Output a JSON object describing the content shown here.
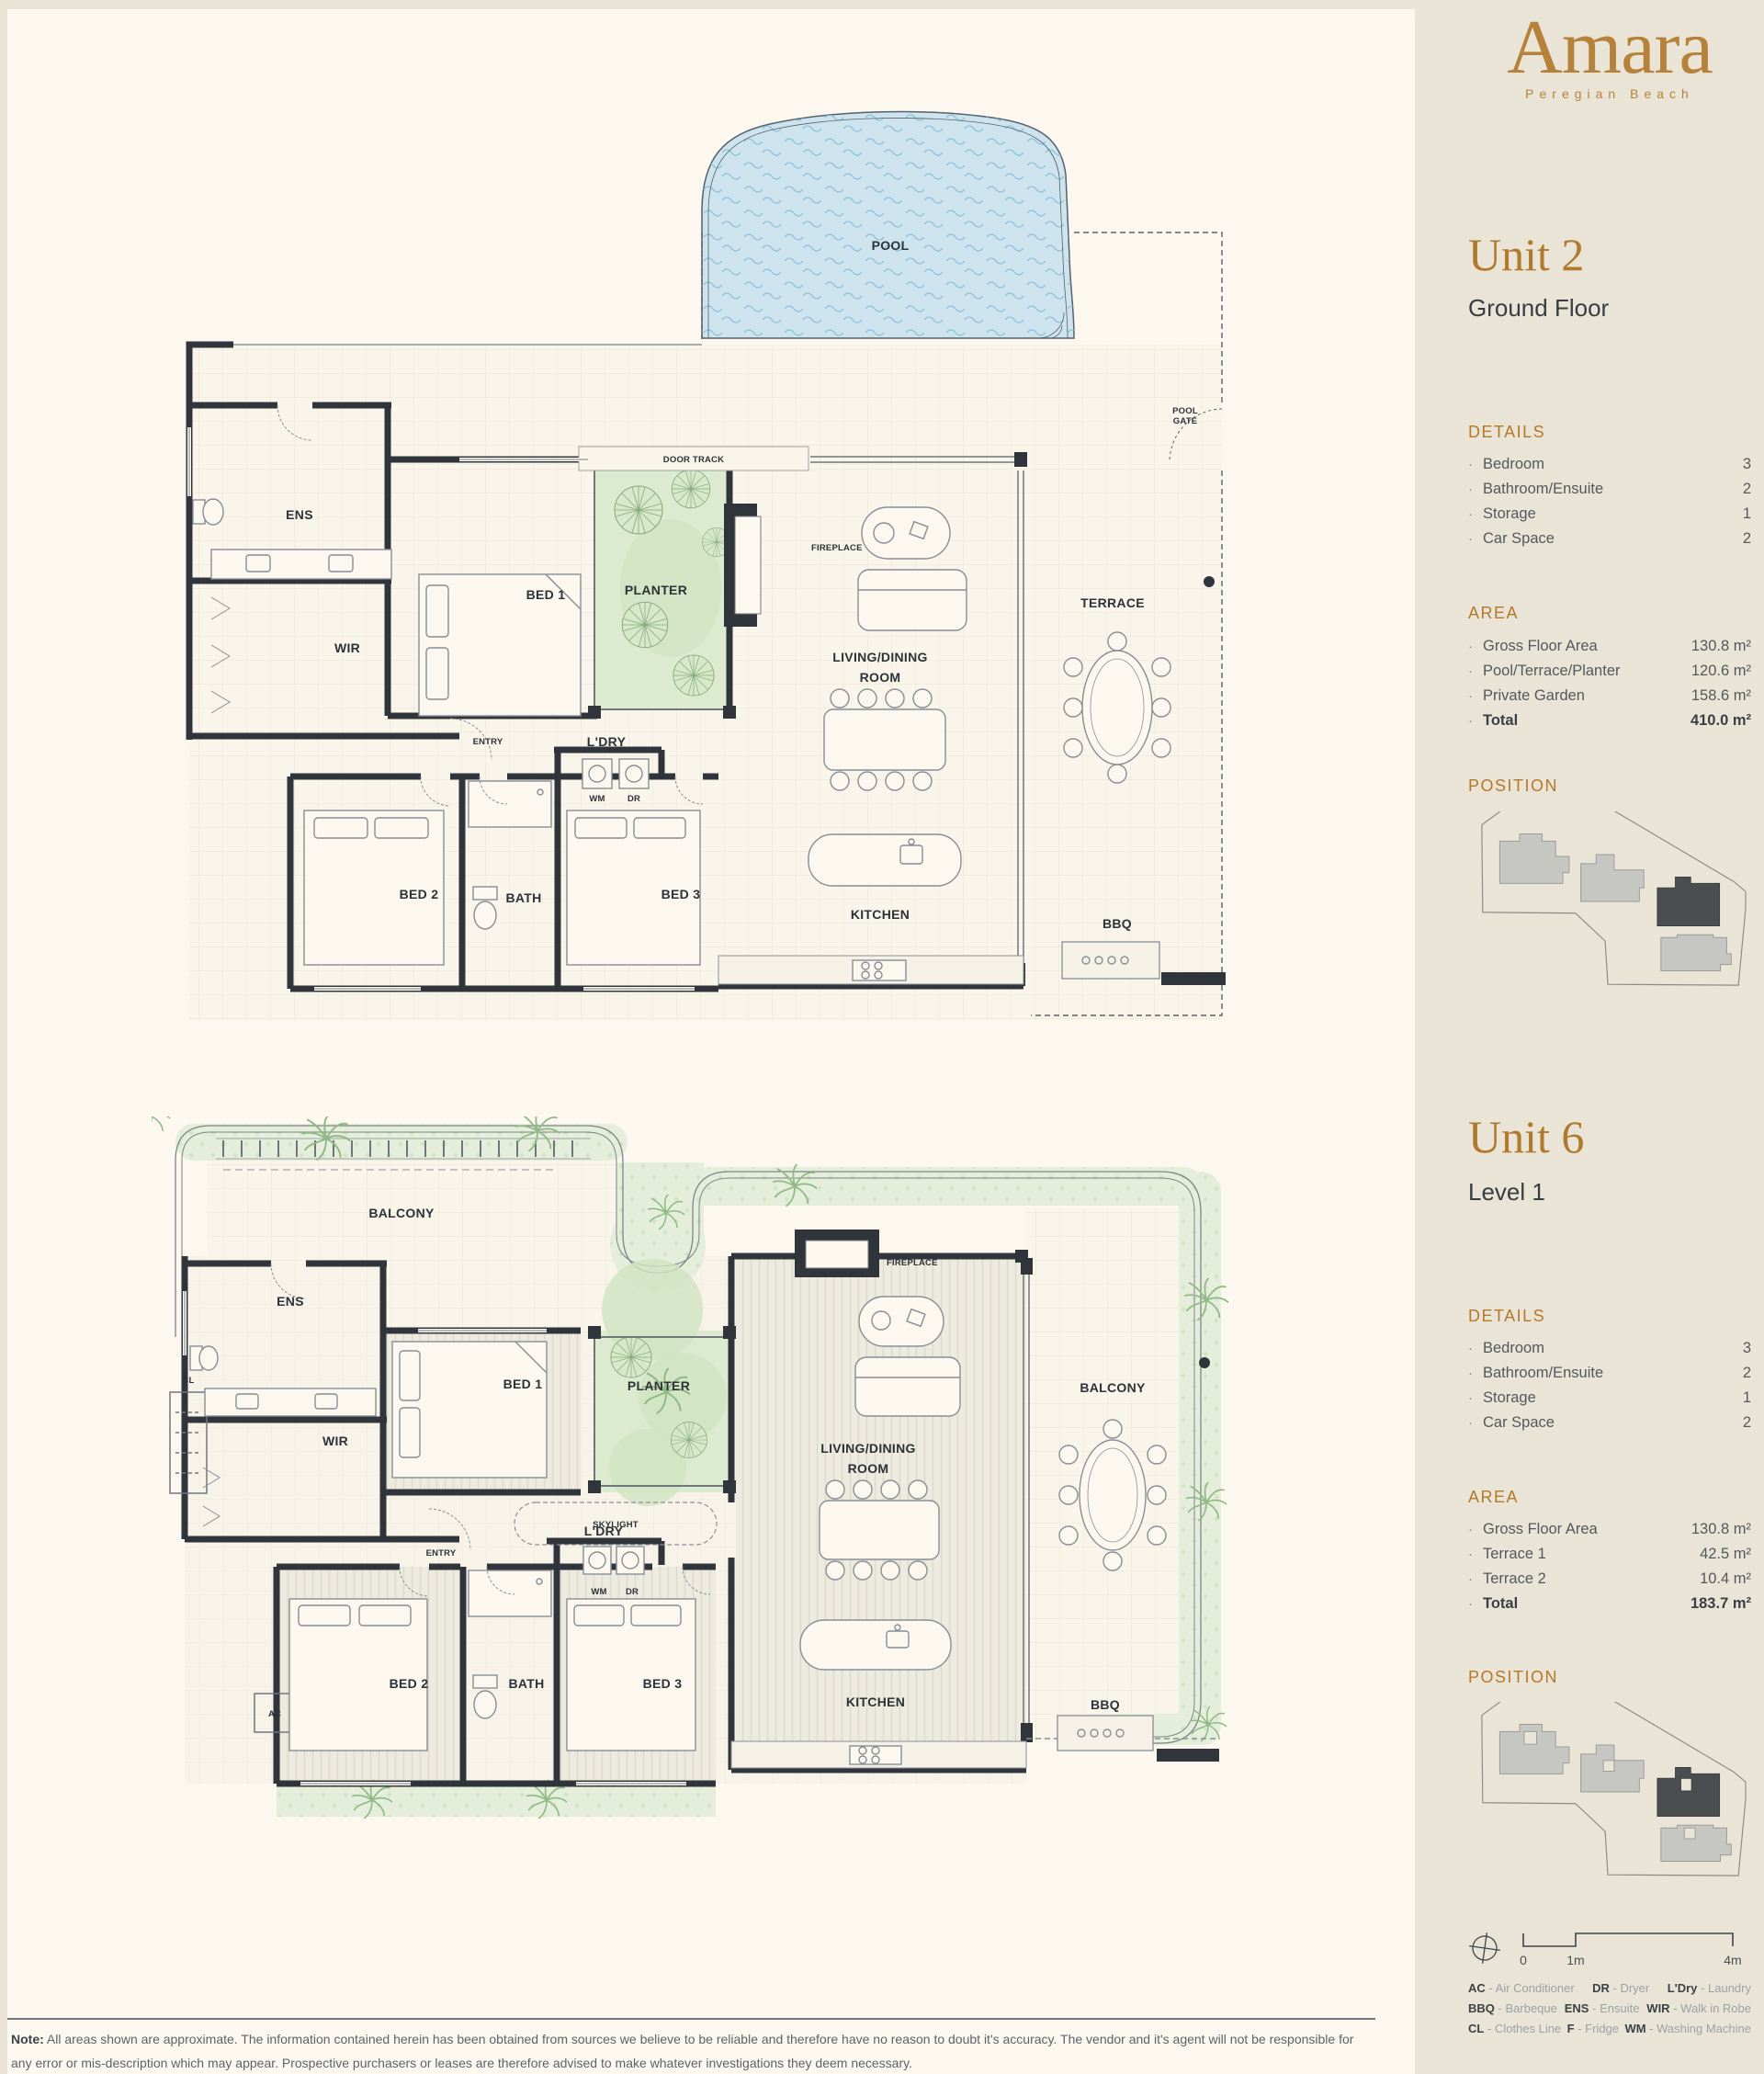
{
  "brand": {
    "name": "Amara",
    "tagline": "Peregian Beach"
  },
  "units": [
    {
      "name": "Unit 2",
      "floor": "Ground Floor",
      "details_title": "DETAILS",
      "details": [
        {
          "label": "Bedroom",
          "value": "3"
        },
        {
          "label": "Bathroom/Ensuite",
          "value": "2"
        },
        {
          "label": "Storage",
          "value": "1"
        },
        {
          "label": "Car Space",
          "value": "2"
        }
      ],
      "area_title": "AREA",
      "area": [
        {
          "label": "Gross Floor Area",
          "value": "130.8 m²"
        },
        {
          "label": "Pool/Terrace/Planter",
          "value": "120.6 m²"
        },
        {
          "label": "Private Garden",
          "value": "158.6 m²"
        },
        {
          "label": "Total",
          "value": "410.0 m²"
        }
      ],
      "position_title": "POSITION"
    },
    {
      "name": "Unit 6",
      "floor": "Level 1",
      "details_title": "DETAILS",
      "details": [
        {
          "label": "Bedroom",
          "value": "3"
        },
        {
          "label": "Bathroom/Ensuite",
          "value": "2"
        },
        {
          "label": "Storage",
          "value": "1"
        },
        {
          "label": "Car Space",
          "value": "2"
        }
      ],
      "area_title": "AREA",
      "area": [
        {
          "label": "Gross Floor Area",
          "value": "130.8 m²"
        },
        {
          "label": "Terrace 1",
          "value": "42.5 m²"
        },
        {
          "label": "Terrace 2",
          "value": "10.4 m²"
        },
        {
          "label": "Total",
          "value": "183.7 m²"
        }
      ],
      "position_title": "POSITION"
    }
  ],
  "plans": {
    "unit2": {
      "pool": "POOL",
      "door_track": "DOOR TRACK",
      "pool_gate1": "POOL",
      "pool_gate2": "GATE",
      "fireplace": "FIREPLACE",
      "ens": "ENS",
      "wir": "WIR",
      "bed1": "BED 1",
      "planter": "PLANTER",
      "living1": "LIVING/DINING",
      "living2": "ROOM",
      "terrace": "TERRACE",
      "entry": "ENTRY",
      "ldry": "L'DRY",
      "wm": "WM",
      "dr": "DR",
      "bed2": "BED 2",
      "bath": "BATH",
      "bed3": "BED 3",
      "kitchen": "KITCHEN",
      "bbq": "BBQ"
    },
    "unit6": {
      "balcony1": "BALCONY",
      "ens": "ENS",
      "cl": "CL",
      "wir": "WIR",
      "bed1": "BED 1",
      "planter": "PLANTER",
      "fireplace": "FIREPLACE",
      "living1": "LIVING/DINING",
      "living2": "ROOM",
      "balcony2": "BALCONY",
      "skylight": "SKYLIGHT",
      "entry": "ENTRY",
      "ldry": "L'DRY",
      "wm": "WM",
      "dr": "DR",
      "ac": "AC",
      "bed2": "BED 2",
      "bath": "BATH",
      "bed3": "BED 3",
      "kitchen": "KITCHEN",
      "bbq": "BBQ"
    }
  },
  "scale": {
    "zero": "0",
    "one": "1m",
    "four": "4m"
  },
  "legend": [
    {
      "abbr": "AC",
      "label": "Air Conditioner"
    },
    {
      "abbr": "DR",
      "label": "Dryer"
    },
    {
      "abbr": "L'Dry",
      "label": "Laundry"
    },
    {
      "abbr": "BBQ",
      "label": "Barbeque"
    },
    {
      "abbr": "ENS",
      "label": "Ensuite"
    },
    {
      "abbr": "WIR",
      "label": "Walk in Robe"
    },
    {
      "abbr": "CL",
      "label": "Clothes Line"
    },
    {
      "abbr": "F",
      "label": "Fridge"
    },
    {
      "abbr": "WM",
      "label": "Washing Machine"
    }
  ],
  "ui": {
    "bullet": "·",
    "legend_sep": "-"
  },
  "note": {
    "prefix": "Note:",
    "body": " All areas shown are approximate. The information contained herein has been obtained from sources we believe to be reliable and therefore have no reason to doubt it's accuracy. The vendor and it's agent will not be responsible for any error or mis-description which may appear. Prospective purchasers or leases are therefore advised to make whatever investigations they deem necessary."
  }
}
